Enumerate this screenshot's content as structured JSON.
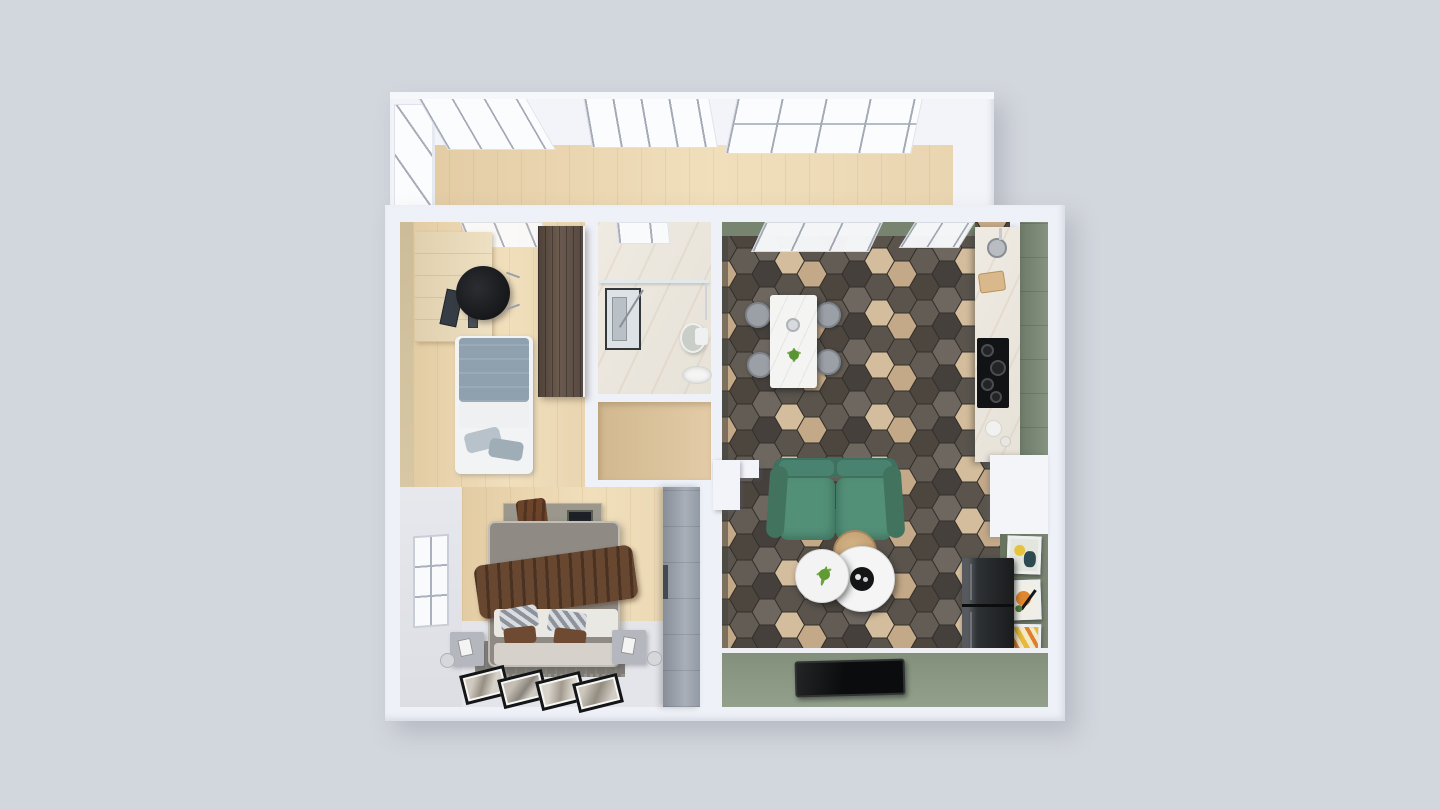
{
  "scene": {
    "type": "3D floor plan render, top-down view of a one-bedroom apartment",
    "background_color": "#d2d6dd",
    "wall_color": "#eff1f8"
  },
  "palette": {
    "balcony_floor_wood": "#eed9b5",
    "office_floor_wood": "#ead6b2",
    "office_accent_wall_beige": "#d6c4a0",
    "office_wardrobe_brown": "#5d4e44",
    "office_bed_duvet": "#8fa0ae",
    "bathroom_marble": "#ece7de",
    "hall_floor_wood": "#dcc49f",
    "bedroom_floor_wood": "#e8d2ab",
    "bedroom_wall_gray": "#e3e4e9",
    "bedroom_wardrobe_gray": "#9aa1ab",
    "bed_throw_brown": "#684730",
    "hex_tile_dark": "#45403b",
    "hex_tile_gray": "#6e6760",
    "hex_tile_wood": "#c3a987",
    "sofa_green": "#4f8470",
    "accent_wall_sage": "#87947f",
    "kitchen_cabinet_green": "#7c8977",
    "fridge_dark": "#2e3134",
    "tv_black": "#0b0c0d",
    "dining_table_white": "#f4f4f2",
    "chair_gray": "#9aa0a6"
  },
  "rooms": {
    "balcony": {
      "name": "balcony with panoramic windows",
      "objects": [
        "panoramic-windows",
        "wood-floor"
      ]
    },
    "home_office": {
      "name": "home office room",
      "objects": [
        "desk-unit",
        "monitor",
        "office-chair",
        "wall-shelves",
        "single-bed",
        "wardrobe"
      ]
    },
    "bathroom": {
      "name": "bathroom",
      "objects": [
        "shower",
        "glass-partition",
        "toilet",
        "sink",
        "towel-rail"
      ]
    },
    "hallway": {
      "name": "hallway",
      "objects": []
    },
    "bedroom": {
      "name": "bedroom",
      "objects": [
        "double-bed",
        "headboard-console",
        "throw-blanket",
        "pillows",
        "nightstand-left",
        "nightstand-right",
        "rug",
        "floor-pictures",
        "wardrobe",
        "window"
      ]
    },
    "living_kitchen": {
      "name": "living room with kitchen",
      "objects": [
        "dining-table",
        "dining-chairs",
        "kitchen-counter",
        "kitchen-sink",
        "cooktop",
        "green-cabinets",
        "sofa",
        "coffee-tables",
        "side-table",
        "fridge",
        "wall-posters",
        "tv",
        "entry-wall"
      ]
    }
  }
}
